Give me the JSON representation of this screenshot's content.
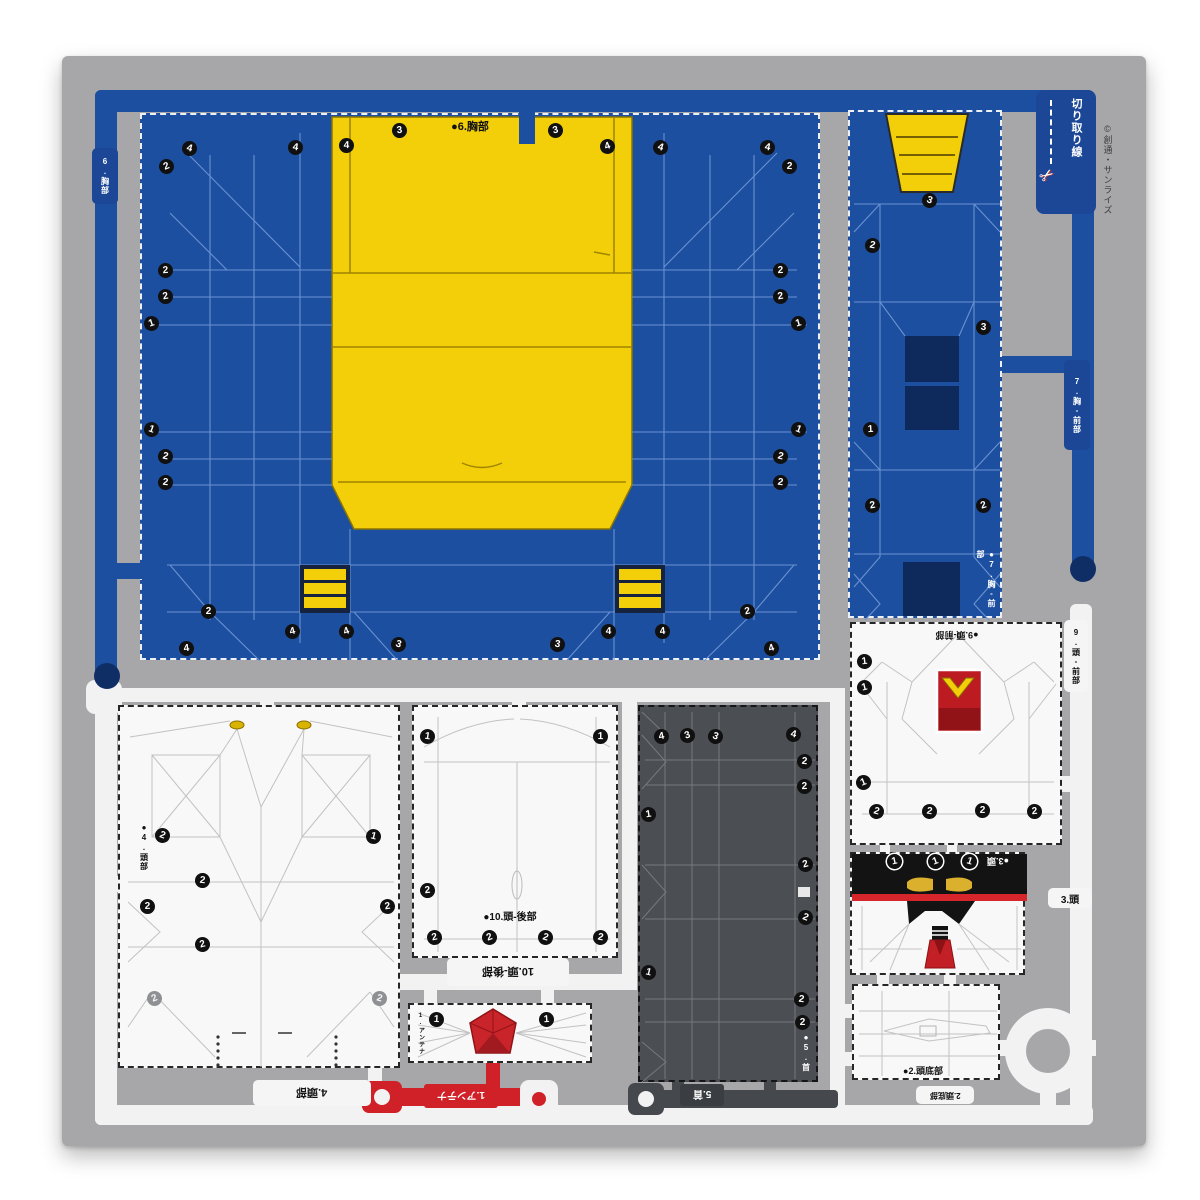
{
  "sheet": {
    "cut_line_label": "切り取り線",
    "scissors_icon": "✂",
    "copyright": "©創通・サンライズ"
  },
  "pieces": {
    "chest": {
      "label": "●6.胸部",
      "tab": "6.胸部"
    },
    "chest_front": {
      "label": "●7.胸-前部",
      "tab": "7.胸-前部"
    },
    "head_part": {
      "label": "●4.頭部",
      "tab": "4.頭部"
    },
    "head_back": {
      "label": "●10.頭-後部",
      "tab": "10.頭-後部"
    },
    "neck": {
      "label": "●5.首",
      "tab": "5.首"
    },
    "head_front": {
      "label": "●9.頭-前部",
      "tab": "9.頭-前部"
    },
    "head": {
      "label": "●3.頭",
      "tab": "3.頭"
    },
    "head_bottom": {
      "label": "●2.頭底部",
      "tab": "2.頭底部"
    },
    "antenna": {
      "label": "1.アンテナ",
      "tiny_label": "1.アンテナ"
    }
  },
  "colors": {
    "blue": "#1d4fa0",
    "navy": "#0e2a5c",
    "yellow": "#f2cf08",
    "red": "#cf2127",
    "dark_gray": "#4b4e53",
    "sheet_gray": "#a7a7a9"
  },
  "markers": [
    [
      167,
      167,
      "2"
    ],
    [
      190,
      149,
      "4"
    ],
    [
      296,
      148,
      "4"
    ],
    [
      347,
      146,
      "4"
    ],
    [
      400,
      131,
      "3"
    ],
    [
      556,
      131,
      "3"
    ],
    [
      608,
      147,
      "4"
    ],
    [
      661,
      148,
      "4"
    ],
    [
      768,
      148,
      "4"
    ],
    [
      790,
      167,
      "2"
    ],
    [
      166,
      271,
      "2"
    ],
    [
      166,
      297,
      "2"
    ],
    [
      152,
      324,
      "1"
    ],
    [
      152,
      430,
      "1"
    ],
    [
      166,
      457,
      "2"
    ],
    [
      166,
      483,
      "2"
    ],
    [
      781,
      271,
      "2"
    ],
    [
      781,
      297,
      "2"
    ],
    [
      799,
      324,
      "1"
    ],
    [
      799,
      430,
      "1"
    ],
    [
      781,
      457,
      "2"
    ],
    [
      781,
      483,
      "2"
    ],
    [
      209,
      612,
      "2"
    ],
    [
      187,
      649,
      "4"
    ],
    [
      293,
      632,
      "4"
    ],
    [
      347,
      632,
      "4"
    ],
    [
      399,
      645,
      "3"
    ],
    [
      558,
      645,
      "3"
    ],
    [
      609,
      632,
      "4"
    ],
    [
      663,
      632,
      "4"
    ],
    [
      748,
      612,
      "2"
    ],
    [
      772,
      649,
      "4"
    ],
    [
      930,
      201,
      "3"
    ],
    [
      873,
      246,
      "2"
    ],
    [
      984,
      328,
      "3"
    ],
    [
      871,
      430,
      "1"
    ],
    [
      873,
      506,
      "2"
    ],
    [
      984,
      506,
      "2"
    ],
    [
      163,
      836,
      "2"
    ],
    [
      374,
      837,
      "1"
    ],
    [
      203,
      881,
      "2"
    ],
    [
      148,
      907,
      "2"
    ],
    [
      388,
      907,
      "2"
    ],
    [
      203,
      945,
      "2"
    ],
    [
      155,
      999,
      "2",
      "g"
    ],
    [
      380,
      999,
      "2",
      "g"
    ],
    [
      428,
      737,
      "1"
    ],
    [
      601,
      737,
      "1"
    ],
    [
      428,
      891,
      "2"
    ],
    [
      435,
      938,
      "2"
    ],
    [
      490,
      938,
      "2"
    ],
    [
      546,
      938,
      "2"
    ],
    [
      601,
      938,
      "2"
    ],
    [
      437,
      1020,
      "1"
    ],
    [
      547,
      1020,
      "1"
    ],
    [
      662,
      737,
      "4"
    ],
    [
      688,
      736,
      "3"
    ],
    [
      716,
      737,
      "3"
    ],
    [
      794,
      735,
      "4"
    ],
    [
      805,
      762,
      "2"
    ],
    [
      805,
      787,
      "2"
    ],
    [
      649,
      815,
      "1"
    ],
    [
      806,
      865,
      "2"
    ],
    [
      806,
      918,
      "2"
    ],
    [
      649,
      973,
      "1"
    ],
    [
      802,
      1000,
      "2"
    ],
    [
      803,
      1023,
      "2"
    ],
    [
      865,
      662,
      "1"
    ],
    [
      865,
      688,
      "1"
    ],
    [
      864,
      783,
      "1"
    ],
    [
      877,
      812,
      "2"
    ],
    [
      930,
      812,
      "2"
    ],
    [
      983,
      811,
      "2"
    ],
    [
      1035,
      812,
      "2"
    ],
    [
      895,
      862,
      "1",
      "w"
    ],
    [
      936,
      862,
      "1",
      "w"
    ],
    [
      970,
      862,
      "1",
      "w"
    ]
  ]
}
